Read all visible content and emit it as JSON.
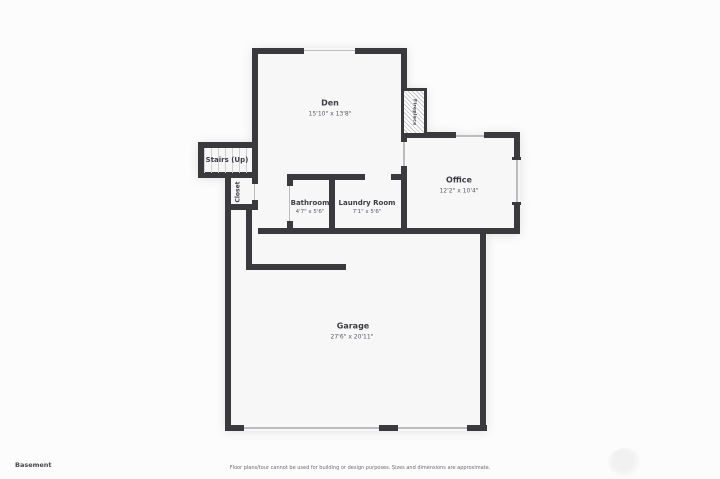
{
  "footer": {
    "floor_label": "Basement",
    "disclaimer": "Floor plans/tour cannot be used for building or design purposes. Sizes and dimensions are approximate."
  },
  "rooms": {
    "den": {
      "name": "Den",
      "dims": "15'10\" x 13'8\""
    },
    "office": {
      "name": "Office",
      "dims": "12'2\" x 10'4\""
    },
    "bathroom": {
      "name": "Bathroom",
      "dims": "4'7\" x 5'6\""
    },
    "laundry": {
      "name": "Laundry Room",
      "dims": "7'1\" x 5'6\""
    },
    "garage": {
      "name": "Garage",
      "dims": "27'6\" x 20'11\""
    },
    "stairs": {
      "name": "Stairs (Up)"
    },
    "closet": {
      "name": "Closet"
    },
    "fireplace": {
      "name": "Fireplace"
    }
  },
  "colors": {
    "wall": "#3a3a3e",
    "room_fill": "#f7f7f8",
    "window_line": "#bcbcbe",
    "background": "#fcfcfc"
  }
}
